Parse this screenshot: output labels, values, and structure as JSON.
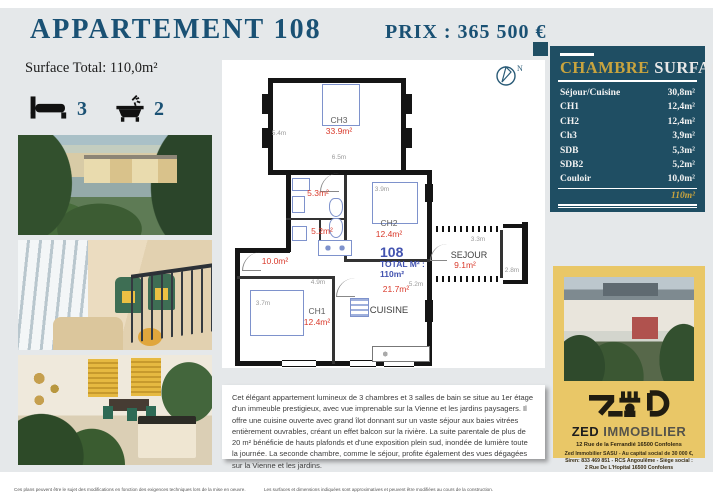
{
  "header": {
    "title": "APPARTEMENT 108",
    "price": "PRIX : 365 500 €"
  },
  "summary": {
    "surface_total": "Surface Total: 110,0m²",
    "bedrooms": "3",
    "bathrooms": "2"
  },
  "floorplan": {
    "compass_label": "N",
    "unit": {
      "number": "108",
      "total_label": "TOTAL M² :",
      "total_value": "110m²"
    },
    "rooms": {
      "ch3": {
        "name": "CH3",
        "area": "33.9m²",
        "dim_h": "5.4m",
        "dim_w": "6.5m"
      },
      "sdb": {
        "area": "5.3m²"
      },
      "sdb2": {
        "area": "5.2m²"
      },
      "ch2": {
        "name": "CH2",
        "area": "12.4m²",
        "dim_w": "3.9m"
      },
      "couloir": {
        "area": "10.0m²"
      },
      "ch1": {
        "name": "CH1",
        "area": "12.4m²",
        "dim_w": "4.9m",
        "dim_h": "3.7m"
      },
      "cuisine": {
        "name": "CUISINE",
        "area": "21.7m²",
        "dim_w": "5.2m"
      },
      "sejour": {
        "name": "SEJOUR",
        "area": "9.1m²",
        "dim_w": "3.3m",
        "dim_h": "2.8m"
      }
    }
  },
  "surface_table": {
    "title_left": "CHAMBRE",
    "title_right": "SURFACE",
    "rows": [
      {
        "label": "Séjour/Cuisine",
        "value": "30,8m²"
      },
      {
        "label": "CH1",
        "value": "12,4m²"
      },
      {
        "label": "CH2",
        "value": "12,4m²"
      },
      {
        "label": "Ch3",
        "value": "3,9m²"
      },
      {
        "label": "SDB",
        "value": "5,3m²"
      },
      {
        "label": "SDB2",
        "value": "5,2m²"
      },
      {
        "label": "Couloir",
        "value": "10,0m²"
      }
    ],
    "total": "110m²"
  },
  "agency": {
    "name_bold": "ZED",
    "name_rest": " IMMOBILIER",
    "address": "12 Rue de la Ferrandié 16500 Confolens",
    "legal_line1": "Zed Immobilier SASU - Au capital social de 30 000 €,",
    "legal_line2": "Siren: 833 469 851 - RCS Angoulême - Siège social :",
    "legal_line3": "2 Rue De L'Hopital 16500 Confolens"
  },
  "description": "Cet élégant appartement lumineux de 3 chambres et 3 salles de bain se situe au 1er étage d'un immeuble prestigieux, avec vue imprenable sur la Vienne et les jardins paysagers. Il offre une cuisine ouverte avec grand îlot donnant sur un vaste séjour aux baies vitrées entièrement ouvrables, créant un effet balcon sur la rivière. La suite parentale de plus de 20 m² bénéficie de hauts plafonds et d'une exposition plein sud, inondée de lumière toute la journée. La seconde chambre, comme le séjour, profite également des vues dégagées sur la Vienne et les jardins.",
  "footer": {
    "left": "Ces  plans peuvent être le sujet des modifications en fonction des exigences techniques lors de la mise en oeuvre.",
    "right": "Les surfaces et dimensions indiquées sont approximatives et peuvent être modifiées au cours de la construction."
  },
  "colors": {
    "accent_blue": "#1a5174",
    "table_teal": "#1f4e63",
    "gold": "#c9a43e",
    "panel_gold": "#e9c767",
    "area_red": "#d93a2b",
    "plan_blue": "#4353b0"
  }
}
